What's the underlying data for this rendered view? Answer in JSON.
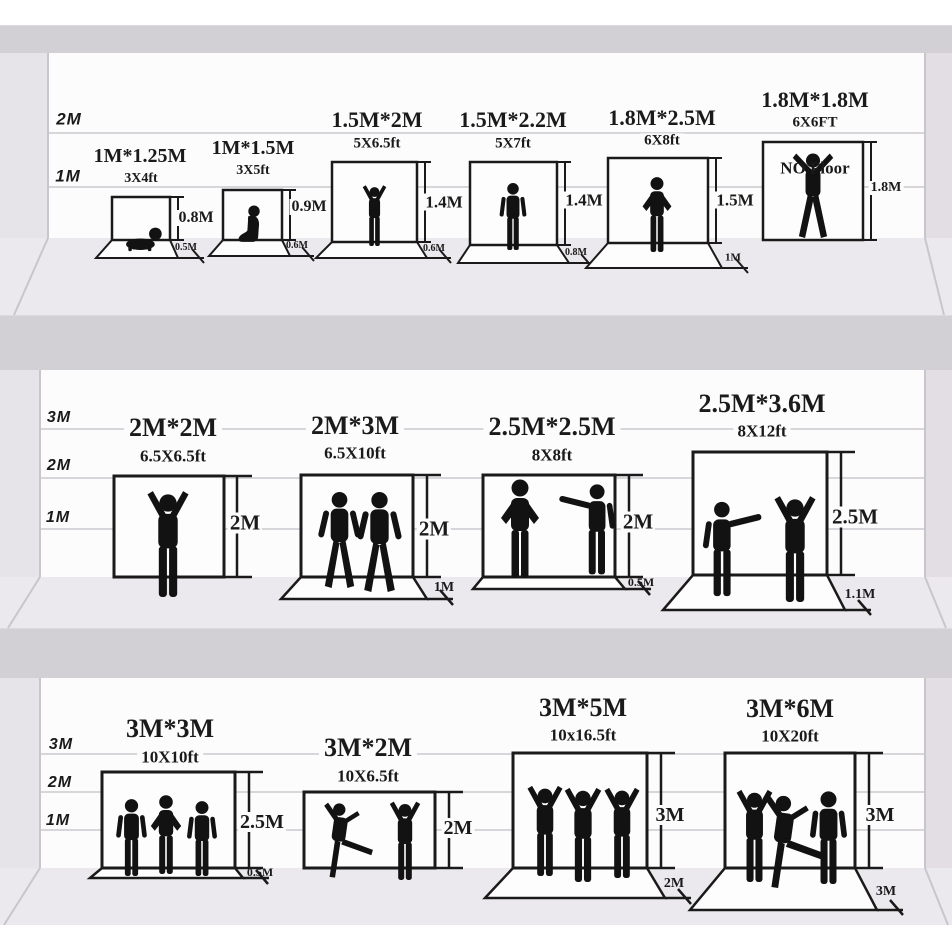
{
  "colors": {
    "ink": "#1a1a1a",
    "wall": "#fcfcfd",
    "floor": "#ebe9ed",
    "shelf_divider": "#d2d0d5",
    "side_wall": "#e6e4e8",
    "gridline": "#d8d6da",
    "silhouette": "#121212"
  },
  "rows": [
    {
      "axis": [
        "2M",
        "1M"
      ],
      "panels": [
        {
          "title": "1M*1.25M",
          "subtitle": "3X4ft",
          "height_label": "0.8M",
          "floor_label": "0.5M",
          "figures": [
            "baby-crawling"
          ]
        },
        {
          "title": "1M*1.5M",
          "subtitle": "3X5ft",
          "height_label": "0.9M",
          "floor_label": "0.6M",
          "figures": [
            "toddler-sitting"
          ]
        },
        {
          "title": "1.5M*2M",
          "subtitle": "5X6.5ft",
          "height_label": "1.4M",
          "floor_label": "0.6M",
          "figures": [
            "child-arms-raised"
          ]
        },
        {
          "title": "1.5M*2.2M",
          "subtitle": "5X7ft",
          "height_label": "1.4M",
          "floor_label": "0.8M",
          "figures": [
            "person-standing"
          ]
        },
        {
          "title": "1.8M*2.5M",
          "subtitle": "6X8ft",
          "height_label": "1.5M",
          "floor_label": "1M",
          "figures": [
            "man-hands-on-hips"
          ]
        },
        {
          "title": "1.8M*1.8M",
          "subtitle": "6X6FT",
          "height_label": "1.8M",
          "no_floor_label": "NO Floor",
          "figures": [
            "man-arms-spread"
          ]
        }
      ]
    },
    {
      "axis": [
        "3M",
        "2M",
        "1M"
      ],
      "panels": [
        {
          "title": "2M*2M",
          "subtitle": "6.5X6.5ft",
          "height_label": "2M",
          "figures": [
            "person-arms-raised"
          ]
        },
        {
          "title": "2M*3M",
          "subtitle": "6.5X10ft",
          "height_label": "2M",
          "floor_label": "1M",
          "figures": [
            "man-walking",
            "man-walking"
          ]
        },
        {
          "title": "2.5M*2.5M",
          "subtitle": "8X8ft",
          "height_label": "2M",
          "floor_label": "0.5M",
          "figures": [
            "person-gesturing",
            "person-pointing"
          ]
        },
        {
          "title": "2.5M*3.6M",
          "subtitle": "8X12ft",
          "height_label": "2.5M",
          "floor_label": "1.1M",
          "figures": [
            "person-pointing",
            "person-arms-raised"
          ]
        }
      ]
    },
    {
      "axis": [
        "3M",
        "2M",
        "1M"
      ],
      "panels": [
        {
          "title": "3M*3M",
          "subtitle": "10X10ft",
          "height_label": "2.5M",
          "floor_label": "0.5M",
          "figures": [
            "person-standing",
            "person-hands-on-hips",
            "person-standing"
          ]
        },
        {
          "title": "3M*2M",
          "subtitle": "10X6.5ft",
          "height_label": "2M",
          "figures": [
            "dancer-kicking",
            "dancer-arms-up"
          ]
        },
        {
          "title": "3M*5M",
          "subtitle": "10x16.5ft",
          "height_label": "3M",
          "floor_label": "2M",
          "figures": [
            "dancer-arms-up",
            "dancer-arms-up",
            "dancer-arms-up"
          ]
        },
        {
          "title": "3M*6M",
          "subtitle": "10X20ft",
          "height_label": "3M",
          "floor_label": "3M",
          "figures": [
            "dancer-arms-up",
            "dancer-kicking",
            "person-standing"
          ]
        }
      ]
    }
  ]
}
